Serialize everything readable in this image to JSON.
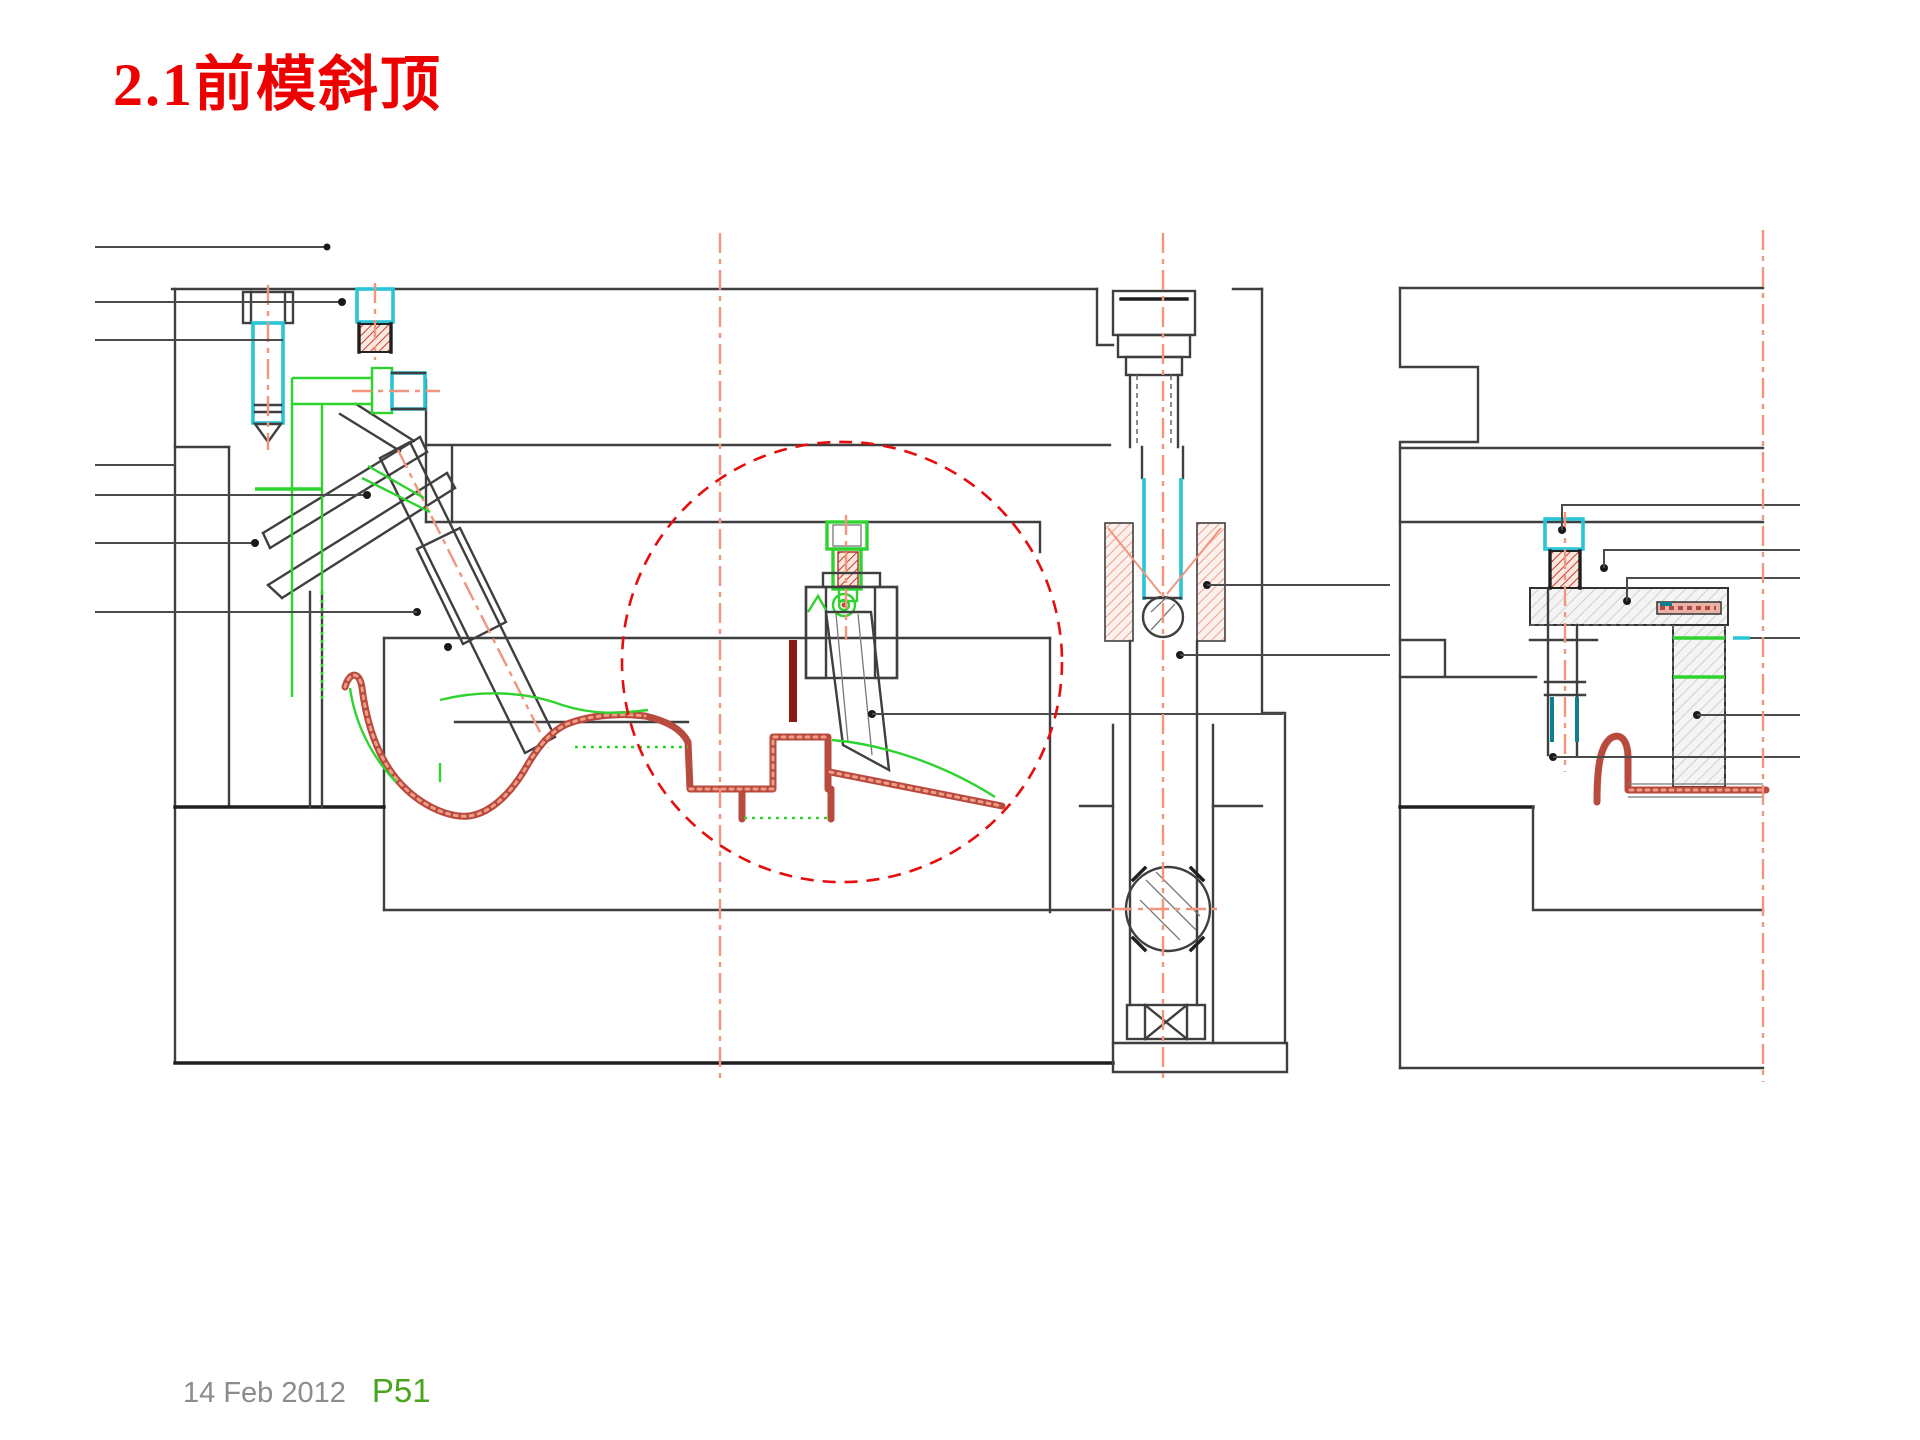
{
  "slide": {
    "title": "2.1前模斜顶",
    "footer": {
      "date": "14 Feb 2012",
      "page": "P51"
    }
  },
  "drawing": {
    "type": "technical-cad-section",
    "views": [
      "left-section-view",
      "right-section-view"
    ],
    "highlight_circle": {
      "style": "red-dashed",
      "purpose": "lifter-detail-emphasis"
    },
    "colors": {
      "outline": "#3f3f3f",
      "title_red": "#ee0000",
      "detail_circle_red": "#e60d0d",
      "part_section_red": "#b94a3e",
      "centerline_salmon": "#f2957d",
      "accent_green": "#2fd32f",
      "accent_cyan": "#29c5d6",
      "accent_teal": "#0e7f8c",
      "footer_gray": "#8c8c8c",
      "page_number_green": "#4aa41c"
    }
  }
}
